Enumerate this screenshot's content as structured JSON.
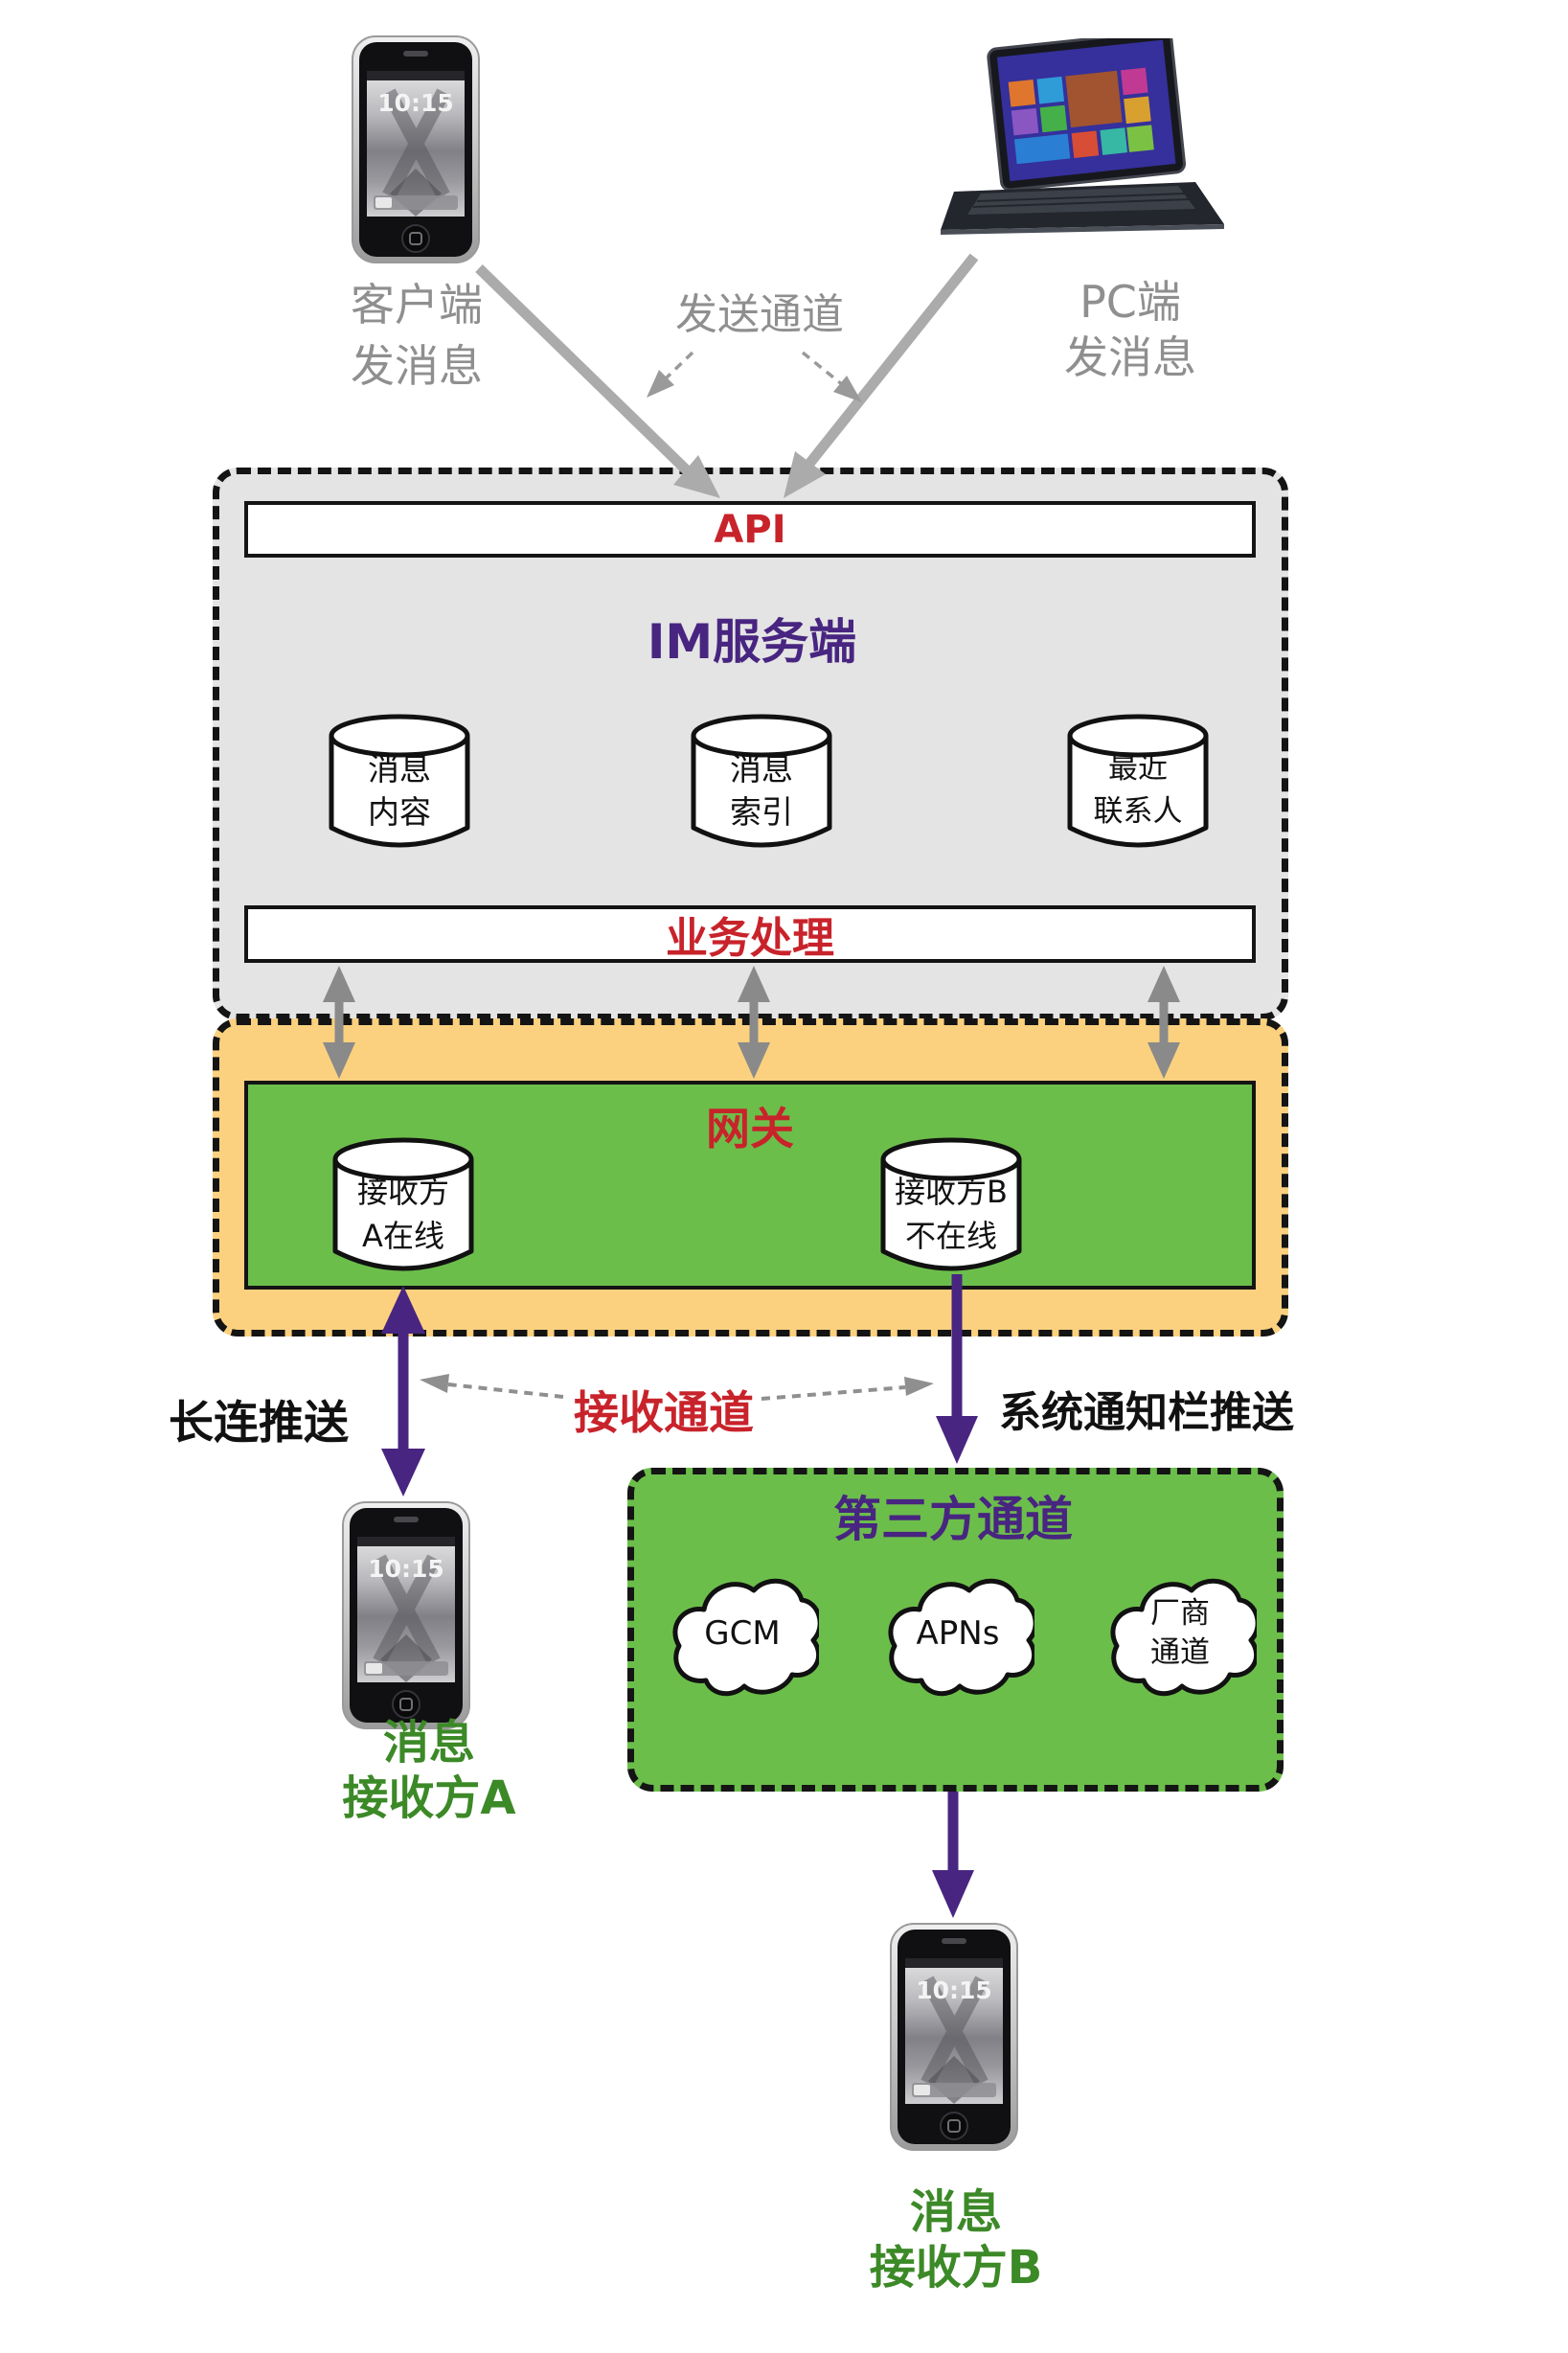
{
  "senders": {
    "mobile": {
      "line1": "客户端",
      "line2": "发消息"
    },
    "pc": {
      "line1": "PC端",
      "line2": "发消息"
    },
    "send_channel_label": "发送通道"
  },
  "im_server": {
    "api_label": "API",
    "title": "IM服务端",
    "business_label": "业务处理",
    "databases": [
      {
        "line1": "消息",
        "line2": "内容"
      },
      {
        "line1": "消息",
        "line2": "索引"
      },
      {
        "line1": "最近",
        "line2": "联系人"
      }
    ]
  },
  "gateway": {
    "title": "网关",
    "nodes": [
      {
        "line1": "接收方",
        "line2": "A在线"
      },
      {
        "line1": "接收方B",
        "line2": "不在线"
      }
    ]
  },
  "push_labels": {
    "long_connection": "长连推送",
    "receive_channel": "接收通道",
    "system_notification": "系统通知栏推送"
  },
  "third_party": {
    "title": "第三方通道",
    "channels": [
      {
        "line1": "GCM",
        "line2": ""
      },
      {
        "line1": "APNs",
        "line2": ""
      },
      {
        "line1": "厂商",
        "line2": "通道"
      }
    ]
  },
  "receivers": {
    "a": {
      "line1": "消息",
      "line2": "接收方A"
    },
    "b": {
      "line1": "消息",
      "line2": "接收方B"
    }
  },
  "device": {
    "phone_time": "10:15"
  },
  "colors": {
    "im_box_fill": "#e4e4e4",
    "channel_box_fill": "#fbd17f",
    "green_fill": "#6cbe4b",
    "accent_red": "#c8232b",
    "accent_purple": "#482580",
    "receiver_text_green": "#3c8927",
    "sender_text_gray": "#8f8f8f",
    "arrow_gray": "#ababab"
  }
}
